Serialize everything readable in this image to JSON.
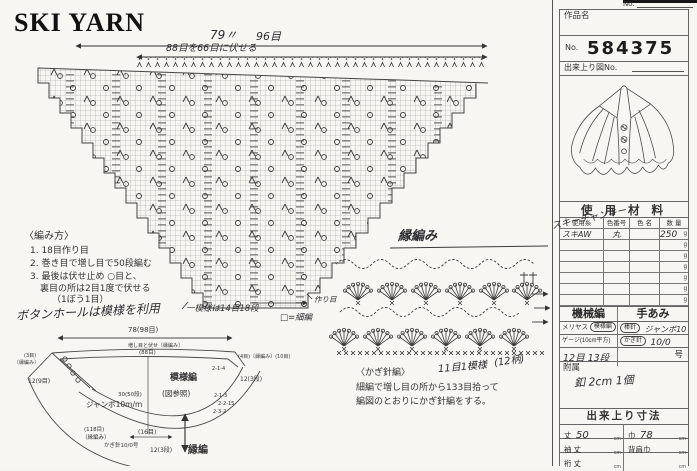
{
  "logo": "SKI YARN",
  "chart": {
    "dim_width": "79〃",
    "dim_sts": "96目",
    "bindoff_note": "88目を66目に伏せる",
    "repeat_note": "一模様は14目18段",
    "legend": "□=細編",
    "caston_note": "作り目"
  },
  "instructions": {
    "heading": "〈編み方〉",
    "items": [
      "1. 18目作り目",
      "2. 巻き目で増し目で50段編む",
      "3. 最後は伏せ止め ○目と、",
      "裏目の所は2目1度で伏せる",
      "（1ぼう1目）"
    ],
    "note": "ボタンホールは模様を利用"
  },
  "schematic": {
    "top_dim": "78(98目)",
    "top_note": "増し目と伏せ〔縁編み〕",
    "inner_dim": "(88目)",
    "left_sts": "(3目)",
    "left_edge": "〔縁編み〕",
    "left_dim": "12(9目)",
    "body_label": "模様編",
    "body_ref": "(図参照)",
    "needle": "ジャンボ10m/m",
    "height_dim": "30(50段)",
    "dec1": "2-1-4",
    "dec2": "2-1-3",
    "dec3": "2-2-15",
    "dec4": "2-3-2",
    "right_note": "(4目)〔縁編み〕(10目)",
    "right_dim": "12(3段)",
    "bottom_sts": "(118目)",
    "bottom_edge": "〔縁編み〕",
    "hook": "かぎ針10/0号",
    "center_sts": "(16目)",
    "band_dim": "12(3段)",
    "band_label": "縁編"
  },
  "crochet": {
    "title": "縁編み",
    "heading": "〈かぎ針編〉",
    "line1": "細編で増し目の所から133目拾って",
    "line2": "編図のとおりにかぎ針編をする。",
    "hand_repeat": "11目1模様",
    "hand_count": "(12柄)"
  },
  "form": {
    "top_no": "No.",
    "title_label": "作品名",
    "no_label": "No.",
    "no_value": "584375",
    "fig_label": "出来上り図No.",
    "materials_header": "使 用 材 料",
    "materials": {
      "col_yarn": "使用糸",
      "col_color_no": "色番号",
      "col_color_name": "色 名",
      "col_qty": "数 量",
      "hand_yarn": "スキーチャンキー",
      "row1_yarn": "スキAW",
      "row1_color_no": "丸",
      "row1_qty": "250",
      "unit": "g"
    },
    "machine_label": "機械編",
    "hand_label": "手あみ",
    "st_type": "メリヤス",
    "st_type_sel": "模様編",
    "needle1_label": "棒針",
    "needle1_value": "ジャンボ10",
    "gauge_label": "ゲージ(10cm平方)",
    "needle2_label": "かぎ針",
    "needle2_value": "10/0",
    "gauge_value": "12目 13段",
    "gou_label": "号",
    "fuzoku_label": "附属",
    "fuzoku_value": "釦 2cm 1個",
    "size_header": "出来上り寸法",
    "size": {
      "r1l_label": "丈",
      "r1l_value": "50",
      "r1r_label": "巾",
      "r1r_value": "78",
      "r2l_label": "袖 丈",
      "r2r_label": "背肩巾",
      "r3l_label": "裄 丈",
      "unit": "cm"
    }
  }
}
